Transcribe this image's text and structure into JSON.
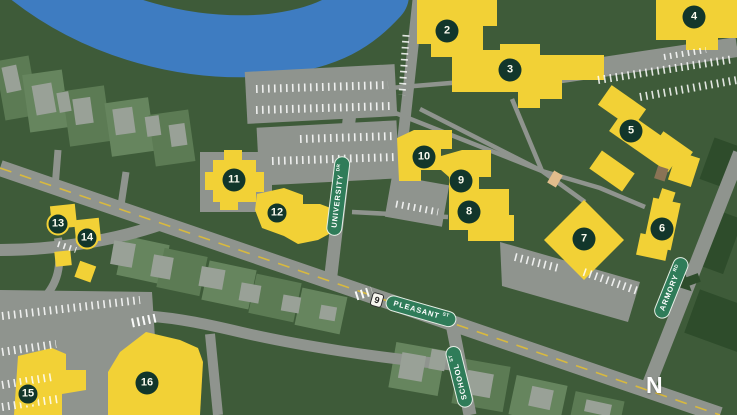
{
  "map": {
    "compass_label": "N",
    "route_shield": {
      "label": "9",
      "x": 377,
      "y": 300,
      "rotation": 16
    },
    "street_labels": [
      {
        "id": "university-dr",
        "name": "UNIVERSITY",
        "suffix": "DR",
        "x": 338,
        "y": 196,
        "rotation": -83
      },
      {
        "id": "pleasant-st",
        "name": "PLEASANT",
        "suffix": "ST",
        "x": 421,
        "y": 311,
        "rotation": 16
      },
      {
        "id": "school-st",
        "name": "SCHOOL",
        "suffix": "ST",
        "x": 459,
        "y": 377,
        "rotation": -104
      },
      {
        "id": "armory-rd",
        "name": "ARMORY",
        "suffix": "RD",
        "x": 671,
        "y": 288,
        "rotation": -68
      }
    ],
    "building_markers": [
      {
        "number": "2",
        "x": 447,
        "y": 31,
        "ring": false
      },
      {
        "number": "3",
        "x": 510,
        "y": 70,
        "ring": false
      },
      {
        "number": "4",
        "x": 694,
        "y": 17,
        "ring": false
      },
      {
        "number": "5",
        "x": 631,
        "y": 131,
        "ring": false
      },
      {
        "number": "6",
        "x": 662,
        "y": 229,
        "ring": false
      },
      {
        "number": "7",
        "x": 584,
        "y": 239,
        "ring": false
      },
      {
        "number": "8",
        "x": 469,
        "y": 212,
        "ring": false
      },
      {
        "number": "9",
        "x": 461,
        "y": 181,
        "ring": false
      },
      {
        "number": "10",
        "x": 424,
        "y": 157,
        "ring": false
      },
      {
        "number": "11",
        "x": 234,
        "y": 180,
        "ring": false
      },
      {
        "number": "12",
        "x": 277,
        "y": 213,
        "ring": true
      },
      {
        "number": "13",
        "x": 58,
        "y": 224,
        "ring": true
      },
      {
        "number": "14",
        "x": 87,
        "y": 238,
        "ring": true
      },
      {
        "number": "15",
        "x": 28,
        "y": 394,
        "ring": true
      },
      {
        "number": "16",
        "x": 147,
        "y": 383,
        "ring": false
      }
    ],
    "colors": {
      "background": "#3E5B39",
      "lot": "#5C7B54",
      "lot_alt": "#66855E",
      "road": "#8F948E",
      "water": "#3E7CC1",
      "building": "#F2D136",
      "marker": "#12362B",
      "marker_text": "#FBFBEF",
      "sign_green": "#2F7C59",
      "centerline": "#D8B93E",
      "house": "#99A197",
      "dark_block": "#2E4C2B",
      "kiosk_tan": "#E2BD8C",
      "kiosk_brown": "#8A7355"
    }
  }
}
